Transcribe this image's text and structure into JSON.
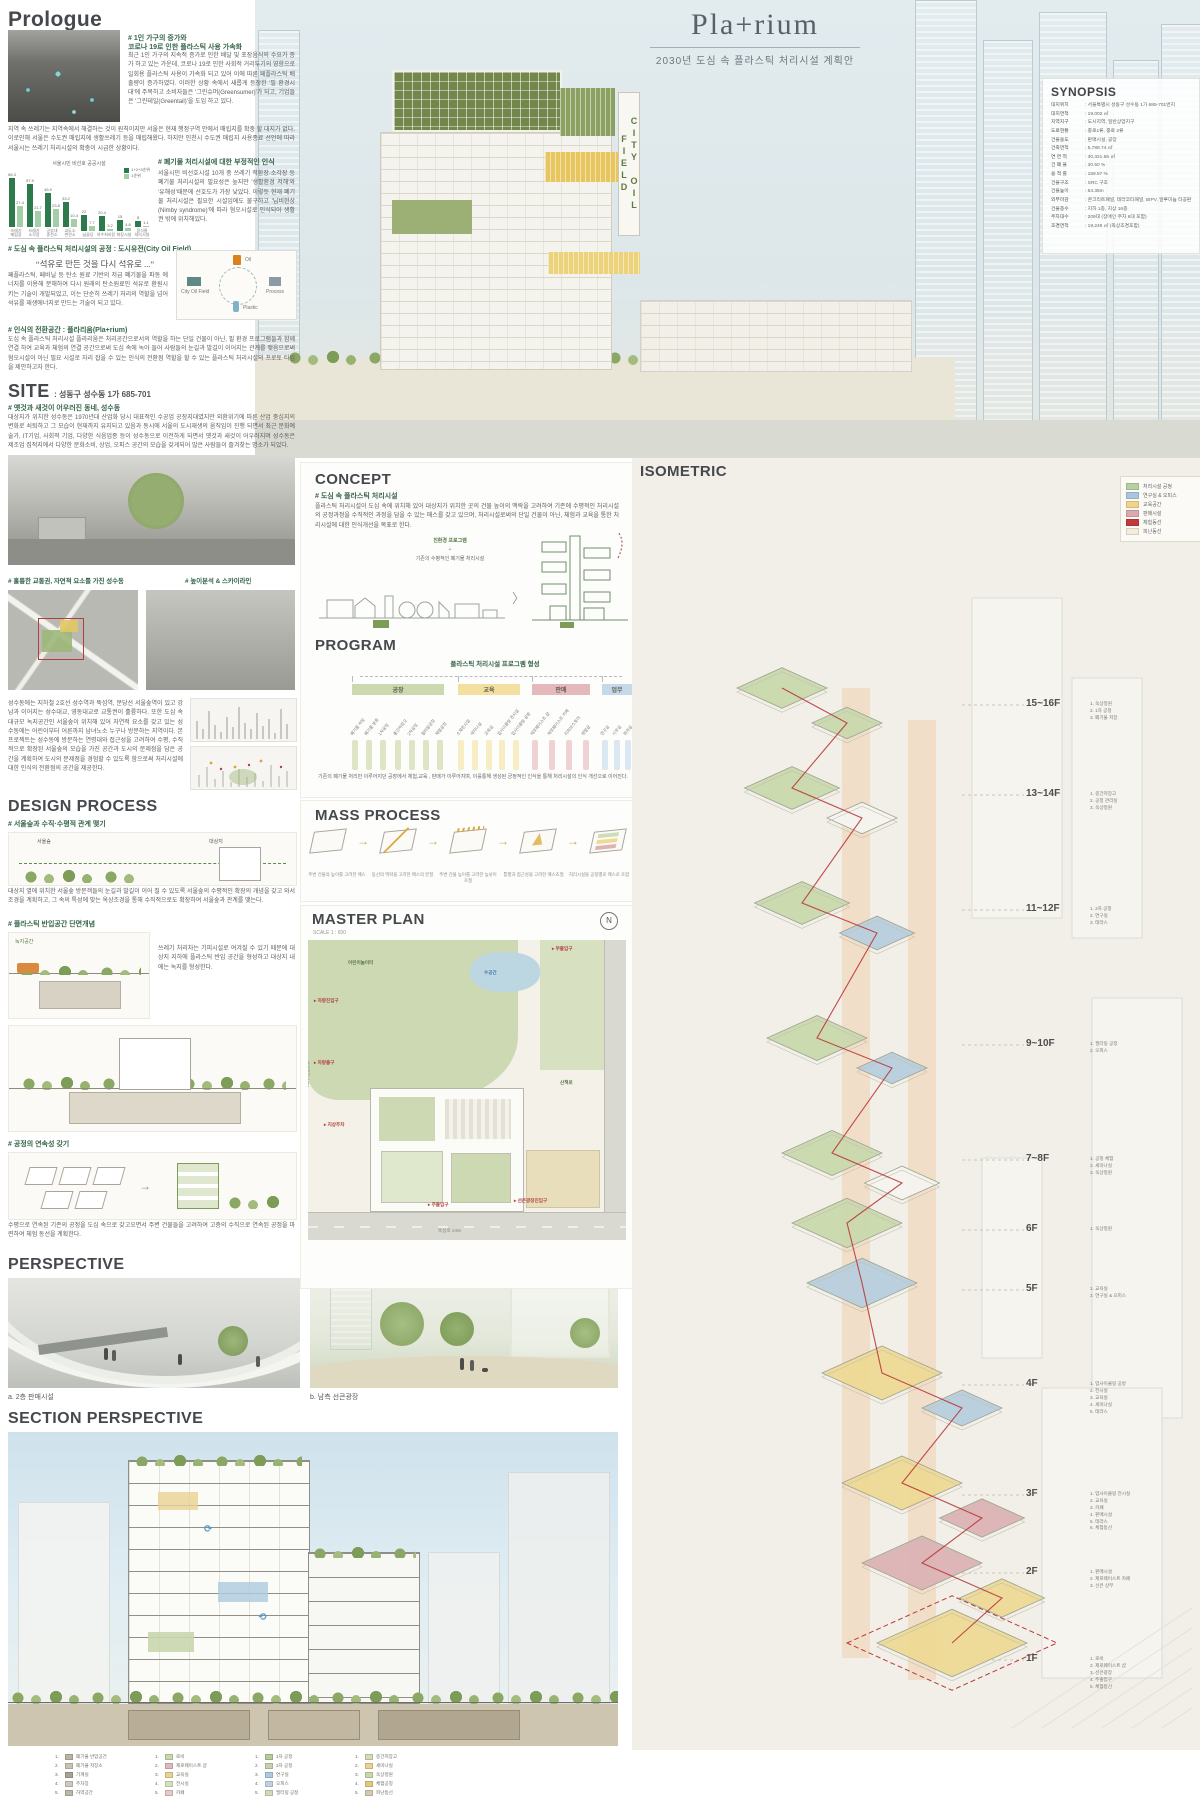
{
  "title": {
    "main": "Pla+rium",
    "subtitle": "2030년 도심 속 플라스틱 처리시설 계획안"
  },
  "hero": {
    "sign": "CITY OIL FIELD"
  },
  "synopsis": {
    "heading": "SYNOPSIS",
    "rows": [
      {
        "k": "대지위치",
        "v": "서울특별시 성동구 성수동 1가 685-701번지"
      },
      {
        "k": "대지면적",
        "v": "19,002 ㎡"
      },
      {
        "k": "지역지구",
        "v": "도시지역, 일반상업지구"
      },
      {
        "k": "도로현황",
        "v": "중로1류, 중로 2류"
      },
      {
        "k": "건물용도",
        "v": "판매시설, 공장"
      },
      {
        "k": "건축면적",
        "v": "5,789.74 ㎡"
      },
      {
        "k": "연 면 적",
        "v": "30,321.66 ㎡"
      },
      {
        "k": "건 폐 율",
        "v": "30.50 %"
      },
      {
        "k": "용 적 률",
        "v": "159.57 %"
      },
      {
        "k": "건물구조",
        "v": "SRC 구조"
      },
      {
        "k": "건물높이",
        "v": "64.35m"
      },
      {
        "k": "외부마감",
        "v": "콘크리트패널, 테라코타패널, BIPV, 알루미늄 타공판"
      },
      {
        "k": "건물층수",
        "v": "지하 1층, 지상 16층"
      },
      {
        "k": "주차대수",
        "v": "209대 (장애인 주차 6대 포함)"
      },
      {
        "k": "조경면적",
        "v": "19,249 ㎡ (옥상조경포함)"
      }
    ]
  },
  "prologue": {
    "heading": "Prologue",
    "s1_heading": "# 1인 가구의 증가와\n코로나 19로 인한 플라스틱 사용 가속화",
    "s1_body": "최근 1인 가구의 지속적 증가로 인한 배달 및 포장음식의 수요가 증가 하고 있는 가운데, 코로나 19로 인한 사회적 거리두기의 영향으로 일회용 플라스틱 사용이 가속화 되고 있어 이에 따른 페플라스틱 배출량이 증가하였다. 이러한 상황 속에서 새롭게 등장한 '필 환경시대'에 주목하고 소비자들은 '그린슈머(Greensumer)'가 되고, 기업들은 '그린테일(Greentail)'을 도입 하고 있다.",
    "s1_wide": "지역 속 쓰레기는 지역속에서 해결하는 것이 원칙이지만 서울은 현재 행정구역 안에서 매립지를 확충 할 대지가 없다. 이로인해 서울은 수도권 매립지에 생활쓰레기 등을 매립해왔다. 하지만 인천시 수도권 매립지 사용종료 선언에 따라 서울시는 쓰레기 처리시설의 확충이 시급한 상황이다.",
    "s2_heading": "# 폐기물 처리시설에 대한 부정적인 인식",
    "s2_body": "서울시민 비선호시설 10개 중 쓰레기 적환장·소각장 등 폐기물 처리시설의 필요성은 높지만 '생활환경 저해'와 '유해성'때문에 선호도가 가장 낮았다. 이렇듯 현재 폐기물 처리시설은 필요한 시설임에도 불구하고 '님비현상(Nimby syndrome)'에 따라 혐오시설로 인식되어 생활권 밖에 위치해있다.",
    "s3_heading": "# 도심 속 플라스틱 처리시설의 공정 : 도시유전(City Oil Field)",
    "s3_quote": "“석유로 만든 것을 다시 석유로 ...”",
    "s3_body": "페플라스틱, 페비닐 등 탄소 원료 기반의 저급 폐기물을 파동 에너지를 이용해 분해하여 다시 원래의 탄소원료인 석유로 환원시키는 기술이 개발되었고, 이는 단순히 쓰레기 처리의 역할을 넘어 석유를 재생에너지로 만드는 기술이 되고 있다.",
    "s3_diagram": {
      "top": "Oil",
      "right": "Process",
      "bottom": "Plastic",
      "left": "City Oil Field"
    },
    "s4_heading": "# 인식의 전환공간 : 플라리움(Pla+rium)",
    "s4_body": "도심 속 플라스틱 처리시설 플라리움은 처리공간으로서의 역할을 하는 단일 건물이 아닌, 필 환경 프로그램들과 함께 연결 하여 교육과 체험의 연결 공간으로써 도심 속에 녹아 들어 사람들의 눈길과 발길이 이어지는 관계를 맺음으로써 혐오시설이 아닌 필요 시설로 자리 잡을 수 있는 인식의 전환점 역할을 할 수 있는 플라스틱 처리시설의 프로토 타입을 제안하고자 한다."
  },
  "chart_data": {
    "type": "bar",
    "title": "서울시민 비선호 공공시설",
    "categories": [
      "쓰레기 매립장",
      "쓰레기 소각장",
      "군부대 송전소",
      "교도소 변전소",
      "납골당",
      "하수처리장",
      "화장시설",
      "음식물 처리시설"
    ],
    "series": [
      {
        "name": "1+2+3순위",
        "color": "#2d7a4c",
        "values": [
          66.3,
          57.9,
          45.9,
          33.2,
          22,
          20.4,
          15,
          8
        ]
      },
      {
        "name": "1순위",
        "color": "#a3cfa6",
        "values": [
          27.4,
          21.7,
          23.8,
          10.4,
          7.7,
          3.2,
          4.8,
          1.1
        ]
      }
    ],
    "ylim": [
      0,
      70
    ],
    "unit": "%",
    "legend_position": "top-right",
    "grid": false
  },
  "site": {
    "heading": "SITE",
    "address": ": 성동구 성수동 1가 685-701",
    "s1_heading": "# 옛것과 새것이 어우러진 동네, 성수동",
    "s1_body": "대상지가 위치한 성수동은 1970년대 산업화 당시 대표적인 수공업 공장지대였지만 외환위기에 따른 산업 중심지의 변화로 쇠퇴하고 그 모습이 현재까지 유지되고 있음과 동시에 서울의 도시재생의 움직임이 진행 되면서 최근 문화예술가, IT기업, 사회적 기업, 다양한 식음업종 등이 성수동으로 이전하게 되면서 옛것과 새것이 어우러지며 성수동은 제조업 집적지에서 다양한 문화소비, 상업, 오피스 공간의 모습을 갖게되어 많은 사람들이 즐겨찾는 명소가 되었다.",
    "s2_heading": "# 훌륭한 교통권, 자연적 요소를 가진 성수동",
    "s3_heading": "# 높이분석 & 스카이라인",
    "s2_body": "성수동에는 지하철 2호선 성수역과 뚝섬역, 분당선 서울숲역이 있고 강남과 이어지는 성수대교, 영동대교로 교통권이 훌륭하다. 또한 도심 속 대규모 녹지공간인 서울숲이 위치해 있어 자연적 요소를 갖고 있는 성수동에는 어린이부터 어른까지 남녀노소 누구나 방문하는 지역이다. 본 프로젝트는 성수동에 방문하는 연령대와 접근성을 고려하여 수평, 수직적으로 확장된 서울숲의 모습을 가진 공간과 도시의 문제점을 담은 공간을 계획하여 도시의 문제점을 경험할 수 있도록 함으로써 처리시설에 대한 인식의 전환점의 공간을 제공한다."
  },
  "concept": {
    "heading": "CONCEPT",
    "s1_heading": "# 도심 속 플라스틱 처리시설",
    "s1_body": "플라스틱 처리시설이 도심 속에 위치해 있어 대상지가 위치한 곳의 건물 높이의 맥락을 고려하여 기존에 수평적인 처리시설의 공정과정을 수직적인 과정을 담을 수 있는 매스를 갖고 있으며, 처리시설로써의 단일 건물이 아닌, 체험과 교육을 통한 처리시설에 대한 인식개선을 목표로 한다.",
    "d_top": "친환경 프로그램",
    "d_plus": "+",
    "d_bottom": "기존의 수평적인 폐기물 처리시설"
  },
  "program": {
    "heading": "PROGRAM",
    "tree_title": "플라스틱 처리시설 프로그램 형성",
    "categories": [
      {
        "name": "공장",
        "color": "#ccd8ae",
        "bar": "#dde5c4",
        "items": [
          "폐기물 저장",
          "폐기물 분류",
          "1차공정",
          "중간저장고",
          "2차공정",
          "필터링공정",
          "체험공정"
        ]
      },
      {
        "name": "교육",
        "color": "#f3dfa0",
        "bar": "#f7ecc2",
        "items": [
          "소재전시실",
          "세미나실",
          "교육실",
          "업사이클링 전시실",
          "업사이클링 공방"
        ]
      },
      {
        "name": "판매",
        "color": "#e5b9bb",
        "bar": "#efd2d3",
        "items": [
          "제로웨이스트 샵",
          "제로웨이스트 카페",
          "리퍼브스토어",
          "렌탈샵"
        ]
      },
      {
        "name": "업무",
        "color": "#c6d9e9",
        "bar": "#dbe7f1",
        "items": [
          "연구실",
          "사무실",
          "회의실"
        ]
      }
    ],
    "caption": "기존의 폐기물 처리만 이루어지던 공장에서 체험,교육 , 판매가 이루어지며, 이를통해 생성된 긍정적인 인식을 통해 처리시설의 인식 개선으로 이어진다."
  },
  "design": {
    "heading": "DESIGN PROCESS",
    "s1_heading": "# 서울숲과 수직·수평적 관계 맺기",
    "s1_label_a": "서울숲",
    "s1_label_b": "대상지",
    "s1_body": "대상지 옆에 위치한 서울숲 방문객들의 눈길과 발길이 이어 질 수 있도록 서울숲의 수평적인 확장의 개념을 갖고 와서 조경을 계획하고, 그 속의 특성에 맞는 옥상조경을 통해 수직적으로도 확장하여 서울숲과 관계를 맺는다.",
    "s2_heading": "# 플라스틱 반입공간 단면개념",
    "s2_label": "녹지공간",
    "s2_body": "쓰레기 처리차는 기피시설로 여겨질 수 있기 때문에 대상지 지하에 플라스틱 반입 공간을 형성하고 대상지 내에는 녹지를 형성한다.",
    "s3_heading": "# 공정의 연속성 갖기",
    "s3_body": "수평으로 연속된 기존의 공정을 도심 속으로 갖고오면서 주변 건물들을 고려하여 고층의 수직으로 연속된 공정을 마련하여 체험 동선을 계획한다."
  },
  "mass": {
    "heading": "MASS PROCESS",
    "steps": [
      "주변 건물의 높이를 고려한 매스",
      "동선의 맥락을 고려한 매스의 분절",
      "주변 건물 높이를 고려한 높낮이 조절",
      "통행과 접근성을 고려한 매스조절",
      "처리시설을 공정별로 매스로 조합"
    ]
  },
  "master": {
    "heading": "MASTER PLAN",
    "scale": "SCALE 1 : 600",
    "road_a": "성덕정길 19M",
    "road_b": "뚝섬로 24M",
    "labels": [
      "차량진입구",
      "차량출구",
      "지상주차",
      "주출입구",
      "부출입구",
      "선큰광장진입구",
      "수공간",
      "산책로",
      "어린이놀이터"
    ]
  },
  "perspective": {
    "heading": "PERSPECTIVE",
    "caption_a": "a. 2층 판매시설",
    "caption_b": "b. 남측 선큰광장"
  },
  "section": {
    "heading": "SECTION PERSPECTIVE",
    "legend_groups": [
      [
        {
          "c": "#b9b3a4",
          "t": "폐기물 반입공간"
        },
        {
          "c": "#c8c2b2",
          "t": "폐기물 저장소"
        },
        {
          "c": "#a9a294",
          "t": "기계실"
        },
        {
          "c": "#cfc9bb",
          "t": "주차장"
        },
        {
          "c": "#bdb7a8",
          "t": "하역공간"
        }
      ],
      [
        {
          "c": "#c9d6ae",
          "t": "로비"
        },
        {
          "c": "#e2b9ba",
          "t": "제로웨이스트 샵"
        },
        {
          "c": "#e8d391",
          "t": "교육실"
        },
        {
          "c": "#d8e0c2",
          "t": "전시실"
        },
        {
          "c": "#e6c9ca",
          "t": "카페"
        }
      ],
      [
        {
          "c": "#b5cc99",
          "t": "1차 공정"
        },
        {
          "c": "#c2d4a8",
          "t": "2차 공정"
        },
        {
          "c": "#aecadf",
          "t": "연구실"
        },
        {
          "c": "#bfd3e4",
          "t": "오피스"
        },
        {
          "c": "#cfdcb8",
          "t": "필터링 공정"
        }
      ],
      [
        {
          "c": "#cfdcb8",
          "t": "중간저장고"
        },
        {
          "c": "#e8d391",
          "t": "세미나실"
        },
        {
          "c": "#c9d6ae",
          "t": "옥상정원"
        },
        {
          "c": "#e2c97e",
          "t": "체험공정"
        },
        {
          "c": "#d5c9b2",
          "t": "피난동선"
        }
      ]
    ]
  },
  "isometric": {
    "heading": "ISOMETRIC",
    "legend": [
      {
        "label": "처리시설 공정",
        "color": "#b8cfa2"
      },
      {
        "label": "연구실 & 오피스",
        "color": "#a9c6df"
      },
      {
        "label": "교육공간",
        "color": "#f2d389"
      },
      {
        "label": "판매시설",
        "color": "#dba8ac"
      },
      {
        "label": "체험동선",
        "color": "#c23b3c"
      },
      {
        "label": "피난동선",
        "color": "#f3ecdc"
      }
    ],
    "floors": [
      {
        "label": "15~16F",
        "notes": "1. 옥상정원\n2. 1차 공정\n3. 폐기물 저장"
      },
      {
        "label": "13~14F",
        "notes": "1. 중간저장고\n2. 공정 관리실\n3. 옥상정원"
      },
      {
        "label": "11~12F",
        "notes": "1. 2차 공정\n2. 연구실\n3. 테라스"
      },
      {
        "label": "9~10F",
        "notes": "1. 필터링 공정\n2. 오피스"
      },
      {
        "label": "7~8F",
        "notes": "1. 공정 체험\n2. 세미나실\n3. 옥상정원"
      },
      {
        "label": "6F",
        "notes": "1. 옥상정원"
      },
      {
        "label": "5F",
        "notes": "1. 교육실\n2. 연구실 & 오피스"
      },
      {
        "label": "4F",
        "notes": "1. 업사이클링 공방\n2. 전시실\n3. 교육실\n4. 세미나실\n5. 테라스"
      },
      {
        "label": "3F",
        "notes": "1. 업사이클링 전시실\n2. 교육실\n3. 카페\n4. 판매시설\n5. 테라스\n6. 체험동선"
      },
      {
        "label": "2F",
        "notes": "1. 판매시설\n2. 제로웨이스트 카페\n3. 선큰 상부"
      },
      {
        "label": "1F",
        "notes": "1. 로비\n2. 제로웨이스트 샵\n3. 선큰광장\n4. 주출입구\n5. 체험동선"
      }
    ]
  },
  "colors": {
    "accent_green": "#35654a",
    "heading_gray": "#45494d",
    "red": "#b0403f",
    "band_blue": "#dee9ed",
    "cream": "#f1efe7"
  }
}
